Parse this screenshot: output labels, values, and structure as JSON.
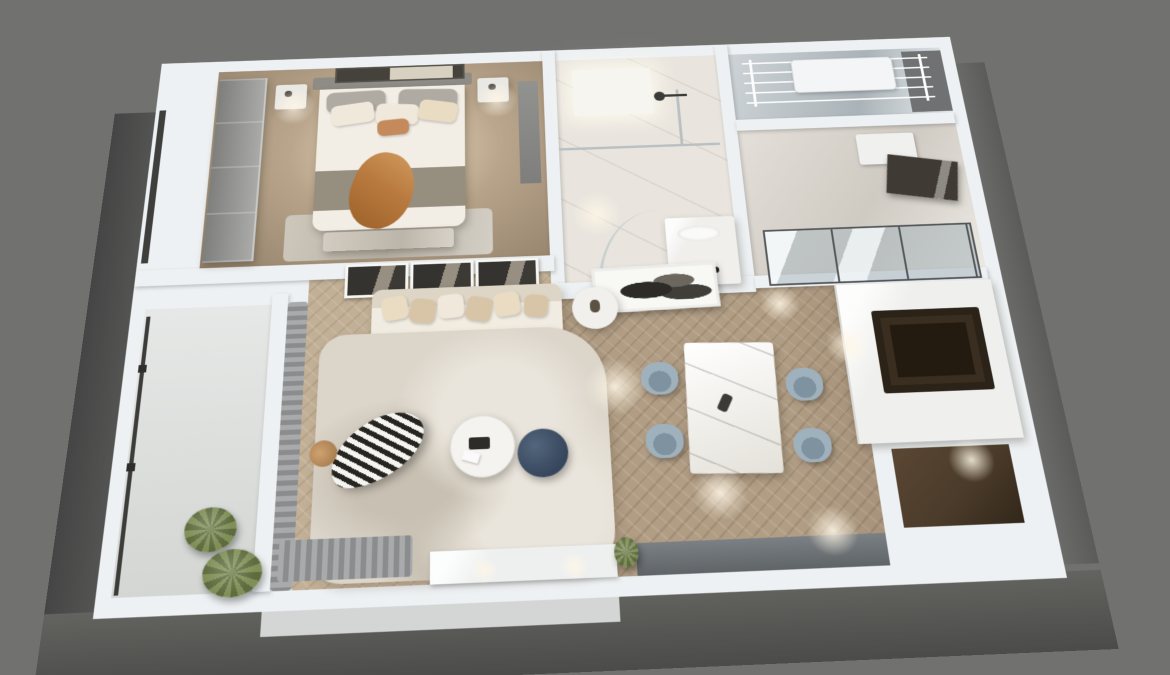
{
  "scene": {
    "type": "3d-apartment-floorplan-render",
    "view": "top-down isometric dollhouse render of a one-bedroom apartment",
    "background": "#71716f"
  },
  "colors": {
    "bg": "#71716f",
    "wall": "#eef1f3",
    "ext-face-dark": "#4b4b49",
    "ext-face": "#5e5e5c",
    "bedroom-carpet": "#b5a188",
    "bedroom-carpet-light": "#d2bfa4",
    "bedroom-carpet-dark": "#93816a",
    "wood": "#b19d84",
    "wood-light": "#c2b096",
    "marble-floor": "#e9e5de",
    "glass-frame": "#54575a",
    "curtain": "#a8aaab",
    "curtain-dark": "#8a8c8d",
    "sofa": "#f1ece2",
    "sofa-back": "#ddd5c6",
    "pillow-a": "#e9dcc3",
    "pillow-b": "#d8c5a8",
    "pillow-c": "#f0e9db",
    "rust": "#b97a3f",
    "navy": "#36465c",
    "chair": "#9fb1bd",
    "chair-dark": "#7f929f",
    "rug": "#dbd5ca",
    "rug-light": "#eae5dc",
    "rug-dark": "#c8c0b2",
    "plant": "#7f8f57",
    "plant-dark": "#5d6b3e",
    "counter": "#eff0ed",
    "cooktop": "#3a2e21",
    "entrance-floor": "#4b3b2a",
    "sideboard": "#6d7275",
    "art-dark": "#35332f",
    "zebra-dark": "#26251f",
    "zebra-light": "#f4f4f1",
    "bed": "#f2eee6",
    "headboard": "#8f8c86",
    "wardrobe": "#9e9e9c",
    "blanket": "#8e8576"
  },
  "apartment": {
    "rooms": [
      {
        "id": "bedroom",
        "furniture": [
          "wardrobe",
          "double-bed",
          "headboard",
          "pillows",
          "rust-throw",
          "gray-blanket",
          "foot-bench",
          "nightstand-left",
          "nightstand-right",
          "wall-art",
          "tan-carpet",
          "side-panel"
        ]
      },
      {
        "id": "bathroom",
        "furniture": [
          "ceiling-light-panel",
          "shower-glass-partition",
          "shower-head",
          "double-vanity",
          "black-faucets",
          "curved-glass-screen"
        ]
      },
      {
        "id": "utility-balcony",
        "furniture": [
          "ceiling-drying-rack",
          "wall-unit",
          "gray-niche"
        ]
      },
      {
        "id": "glass-room",
        "furniture": [
          "sliding-glass-doors",
          "white-cabinet",
          "dark-vanity-desk"
        ]
      },
      {
        "id": "kitchen",
        "furniture": [
          "l-shaped-counter",
          "dark-cooktop",
          "gray-sideboard"
        ]
      },
      {
        "id": "dining-area",
        "furniture": [
          "marble-dining-table",
          "dining-chair-x4",
          "partition-artwork"
        ]
      },
      {
        "id": "living-room",
        "furniture": [
          "gallery-frame-x3",
          "cream-sofa",
          "throw-pillow-x6",
          "round-side-table",
          "round-coffee-table",
          "navy-ottoman",
          "zebra-lounge-chair",
          "area-rug",
          "tv-console",
          "window-curtains"
        ]
      },
      {
        "id": "balcony",
        "furniture": [
          "glass-railing",
          "potted-plant-x2",
          "terrace-ledge"
        ]
      },
      {
        "id": "entrance",
        "furniture": [
          "dark-wood-foyer-floor"
        ]
      }
    ]
  }
}
